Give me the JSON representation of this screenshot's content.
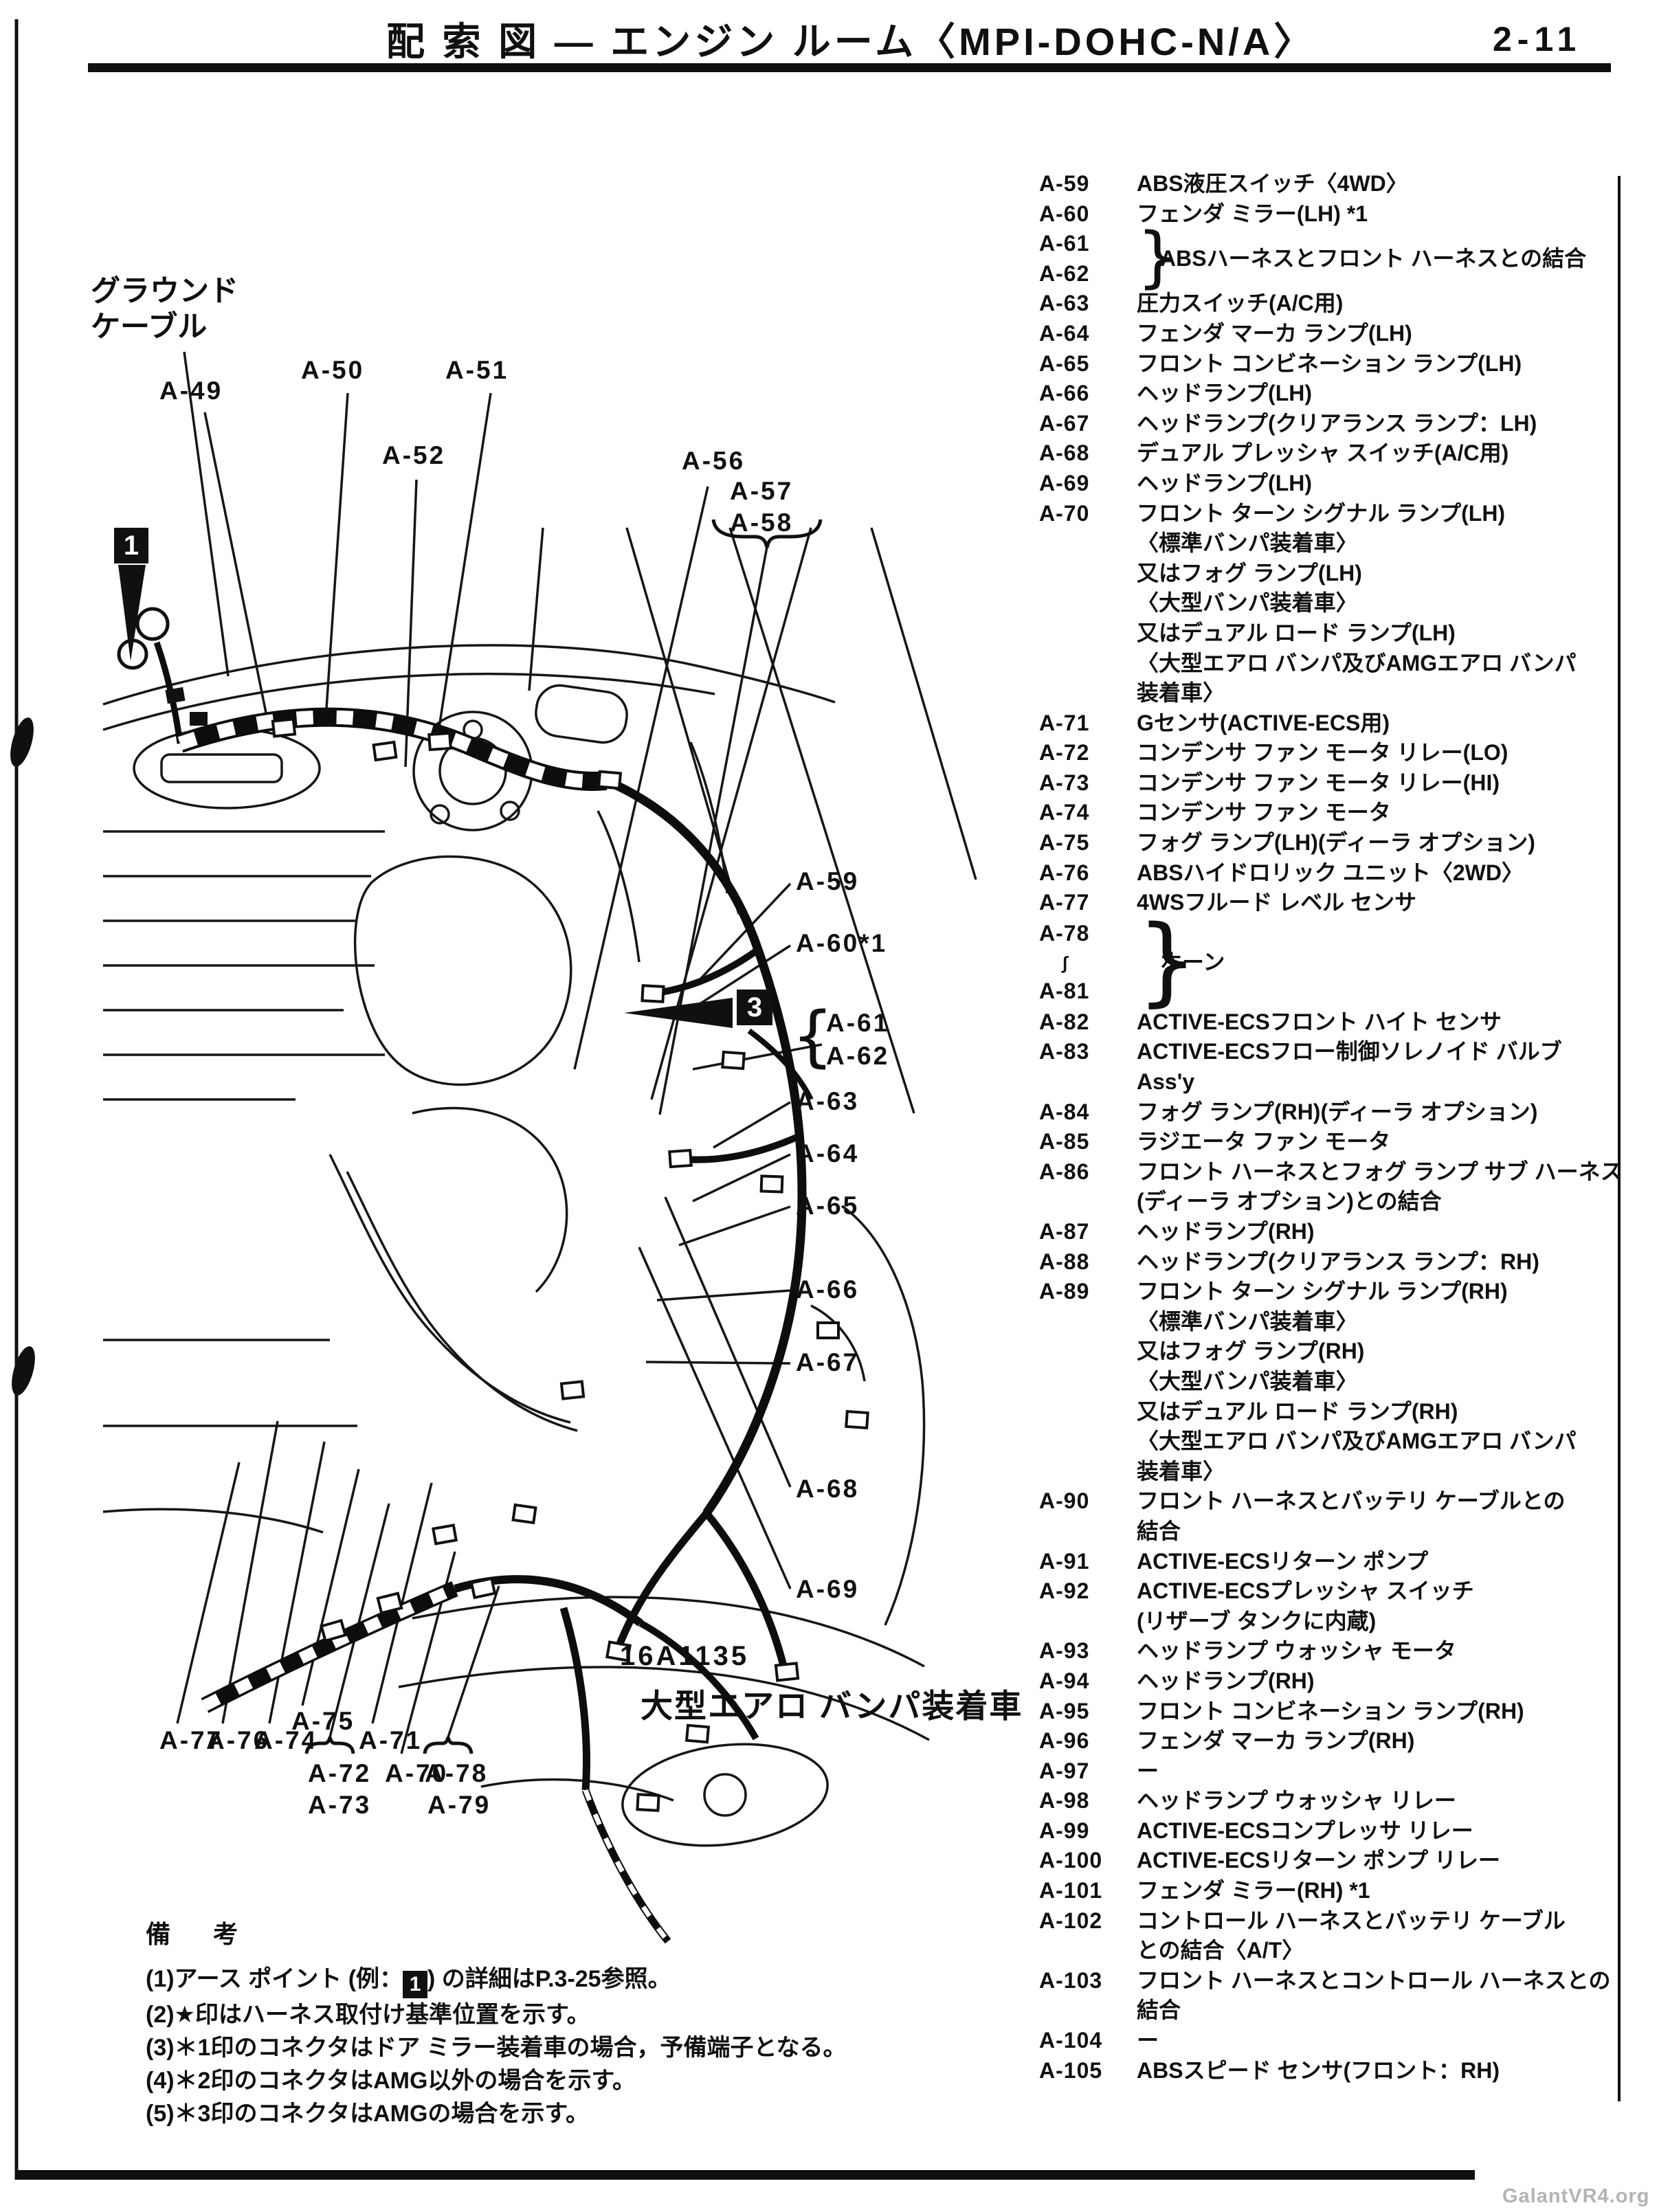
{
  "page": {
    "title": "配 索 図 ― エンジン ルーム〈MPI-DOHC-N/A〉",
    "page_number": "2-11",
    "watermark": "GalantVR4.org"
  },
  "diagram": {
    "ground_label": [
      "グラウンド",
      "ケーブル"
    ],
    "figure_number": "16A1135",
    "figure_caption": "大型エアロ バンパ装着車",
    "markers": [
      {
        "label": "1"
      },
      {
        "label": "3"
      }
    ],
    "brace_open": "{",
    "callouts": [
      {
        "label": "A-49"
      },
      {
        "label": "A-50"
      },
      {
        "label": "A-51"
      },
      {
        "label": "A-52"
      },
      {
        "label": "A-56"
      },
      {
        "label": "A-57"
      },
      {
        "label": "A-58"
      },
      {
        "label": "A-59"
      },
      {
        "label": "A-60*1"
      },
      {
        "label": "A-61"
      },
      {
        "label": "A-62"
      },
      {
        "label": "A-63"
      },
      {
        "label": "A-64"
      },
      {
        "label": "A-65"
      },
      {
        "label": "A-66"
      },
      {
        "label": "A-67"
      },
      {
        "label": "A-68"
      },
      {
        "label": "A-69"
      },
      {
        "label": "A-77"
      },
      {
        "label": "A-76"
      },
      {
        "label": "A-74"
      },
      {
        "label": "A-75"
      },
      {
        "label": "A-72"
      },
      {
        "label": "A-73"
      },
      {
        "label": "A-71"
      },
      {
        "label": "A-70"
      },
      {
        "label": "A-78"
      },
      {
        "label": "A-79"
      }
    ]
  },
  "legend": {
    "brace_glyph": "}",
    "entries": [
      {
        "code": "A-59",
        "lines": [
          "ABS液圧スイッチ〈4WD〉"
        ]
      },
      {
        "code": "A-60",
        "lines": [
          "フェンダ ミラー(LH) *1"
        ]
      },
      {
        "codes": [
          "A-61",
          "A-62"
        ],
        "lines": [
          "ABSハーネスとフロント ハーネスとの結合"
        ]
      },
      {
        "code": "A-63",
        "lines": [
          "圧力スイッチ(A/C用)"
        ]
      },
      {
        "code": "A-64",
        "lines": [
          "フェンダ マーカ ランプ(LH)"
        ]
      },
      {
        "code": "A-65",
        "lines": [
          "フロント コンビネーション ランプ(LH)"
        ]
      },
      {
        "code": "A-66",
        "lines": [
          "ヘッドランプ(LH)"
        ]
      },
      {
        "code": "A-67",
        "lines": [
          "ヘッドランプ(クリアランス ランプ：LH)"
        ]
      },
      {
        "code": "A-68",
        "lines": [
          "デュアル プレッシャ スイッチ(A/C用)"
        ]
      },
      {
        "code": "A-69",
        "lines": [
          "ヘッドランプ(LH)"
        ]
      },
      {
        "code": "A-70",
        "lines": [
          "フロント ターン シグナル ランプ(LH)",
          "〈標準バンパ装着車〉",
          "又はフォグ ランプ(LH)",
          "〈大型バンパ装着車〉",
          "又はデュアル ロード ランプ(LH)",
          "〈大型エアロ バンパ及びAMGエアロ バンパ",
          "装着車〉"
        ]
      },
      {
        "code": "A-71",
        "lines": [
          "Gセンサ(ACTIVE-ECS用)"
        ]
      },
      {
        "code": "A-72",
        "lines": [
          "コンデンサ ファン モータ リレー(LO)"
        ]
      },
      {
        "code": "A-73",
        "lines": [
          "コンデンサ ファン モータ リレー(HI)"
        ]
      },
      {
        "code": "A-74",
        "lines": [
          "コンデンサ ファン モータ"
        ]
      },
      {
        "code": "A-75",
        "lines": [
          "フォグ ランプ(LH)(ディーラ オプション)"
        ]
      },
      {
        "code": "A-76",
        "lines": [
          "ABSハイドロリック ユニット〈2WD〉"
        ]
      },
      {
        "code": "A-77",
        "lines": [
          "4WSフルード レベル センサ"
        ]
      },
      {
        "codes": [
          "A-78",
          "∫",
          "A-81"
        ],
        "lines": [
          "ホーン"
        ]
      },
      {
        "code": "A-82",
        "lines": [
          "ACTIVE-ECSフロント ハイト センサ"
        ]
      },
      {
        "code": "A-83",
        "lines": [
          "ACTIVE-ECSフロー制御ソレノイド バルブ",
          "Ass'y"
        ]
      },
      {
        "code": "A-84",
        "lines": [
          "フォグ ランプ(RH)(ディーラ オプション)"
        ]
      },
      {
        "code": "A-85",
        "lines": [
          "ラジエータ ファン モータ"
        ]
      },
      {
        "code": "A-86",
        "lines": [
          "フロント ハーネスとフォグ ランプ サブ ハーネス",
          "(ディーラ オプション)との結合"
        ]
      },
      {
        "code": "A-87",
        "lines": [
          "ヘッドランプ(RH)"
        ]
      },
      {
        "code": "A-88",
        "lines": [
          "ヘッドランプ(クリアランス ランプ：RH)"
        ]
      },
      {
        "code": "A-89",
        "lines": [
          "フロント ターン シグナル ランプ(RH)",
          "〈標準バンパ装着車〉",
          "又はフォグ ランプ(RH)",
          "〈大型バンパ装着車〉",
          "又はデュアル ロード ランプ(RH)",
          "〈大型エアロ バンパ及びAMGエアロ バンパ",
          "装着車〉"
        ]
      },
      {
        "code": "A-90",
        "lines": [
          "フロント ハーネスとバッテリ ケーブルとの",
          "結合"
        ]
      },
      {
        "code": "A-91",
        "lines": [
          "ACTIVE-ECSリターン ポンプ"
        ]
      },
      {
        "code": "A-92",
        "lines": [
          "ACTIVE-ECSプレッシャ スイッチ",
          "(リザーブ タンクに内蔵)"
        ]
      },
      {
        "code": "A-93",
        "lines": [
          "ヘッドランプ ウォッシャ モータ"
        ]
      },
      {
        "code": "A-94",
        "lines": [
          "ヘッドランプ(RH)"
        ]
      },
      {
        "code": "A-95",
        "lines": [
          "フロント コンビネーション ランプ(RH)"
        ]
      },
      {
        "code": "A-96",
        "lines": [
          "フェンダ マーカ ランプ(RH)"
        ]
      },
      {
        "code": "A-97",
        "lines": [
          "ー"
        ]
      },
      {
        "code": "A-98",
        "lines": [
          "ヘッドランプ ウォッシャ リレー"
        ]
      },
      {
        "code": "A-99",
        "lines": [
          "ACTIVE-ECSコンプレッサ リレー"
        ]
      },
      {
        "code": "A-100",
        "lines": [
          "ACTIVE-ECSリターン ポンプ リレー"
        ]
      },
      {
        "code": "A-101",
        "lines": [
          "フェンダ ミラー(RH) *1"
        ]
      },
      {
        "code": "A-102",
        "lines": [
          "コントロール ハーネスとバッテリ ケーブル",
          "との結合〈A/T〉"
        ]
      },
      {
        "code": "A-103",
        "lines": [
          "フロント ハーネスとコントロール ハーネスとの",
          "結合"
        ]
      },
      {
        "code": "A-104",
        "lines": [
          "ー"
        ]
      },
      {
        "code": "A-105",
        "lines": [
          "ABSスピード センサ(フロント：RH)"
        ]
      }
    ]
  },
  "notes": {
    "heading": "備 考",
    "item1_pre": "(1)アース ポイント (例：",
    "item1_marker": "1",
    "item1_post": ") の詳細はP.3-25参照。",
    "items": [
      "(2)★印はハーネス取付け基準位置を示す。",
      "(3)＊1印のコネクタはドア ミラー装着車の場合，予備端子となる。",
      "(4)＊2印のコネクタはAMG以外の場合を示す。",
      "(5)＊3印のコネクタはAMGの場合を示す。"
    ]
  }
}
